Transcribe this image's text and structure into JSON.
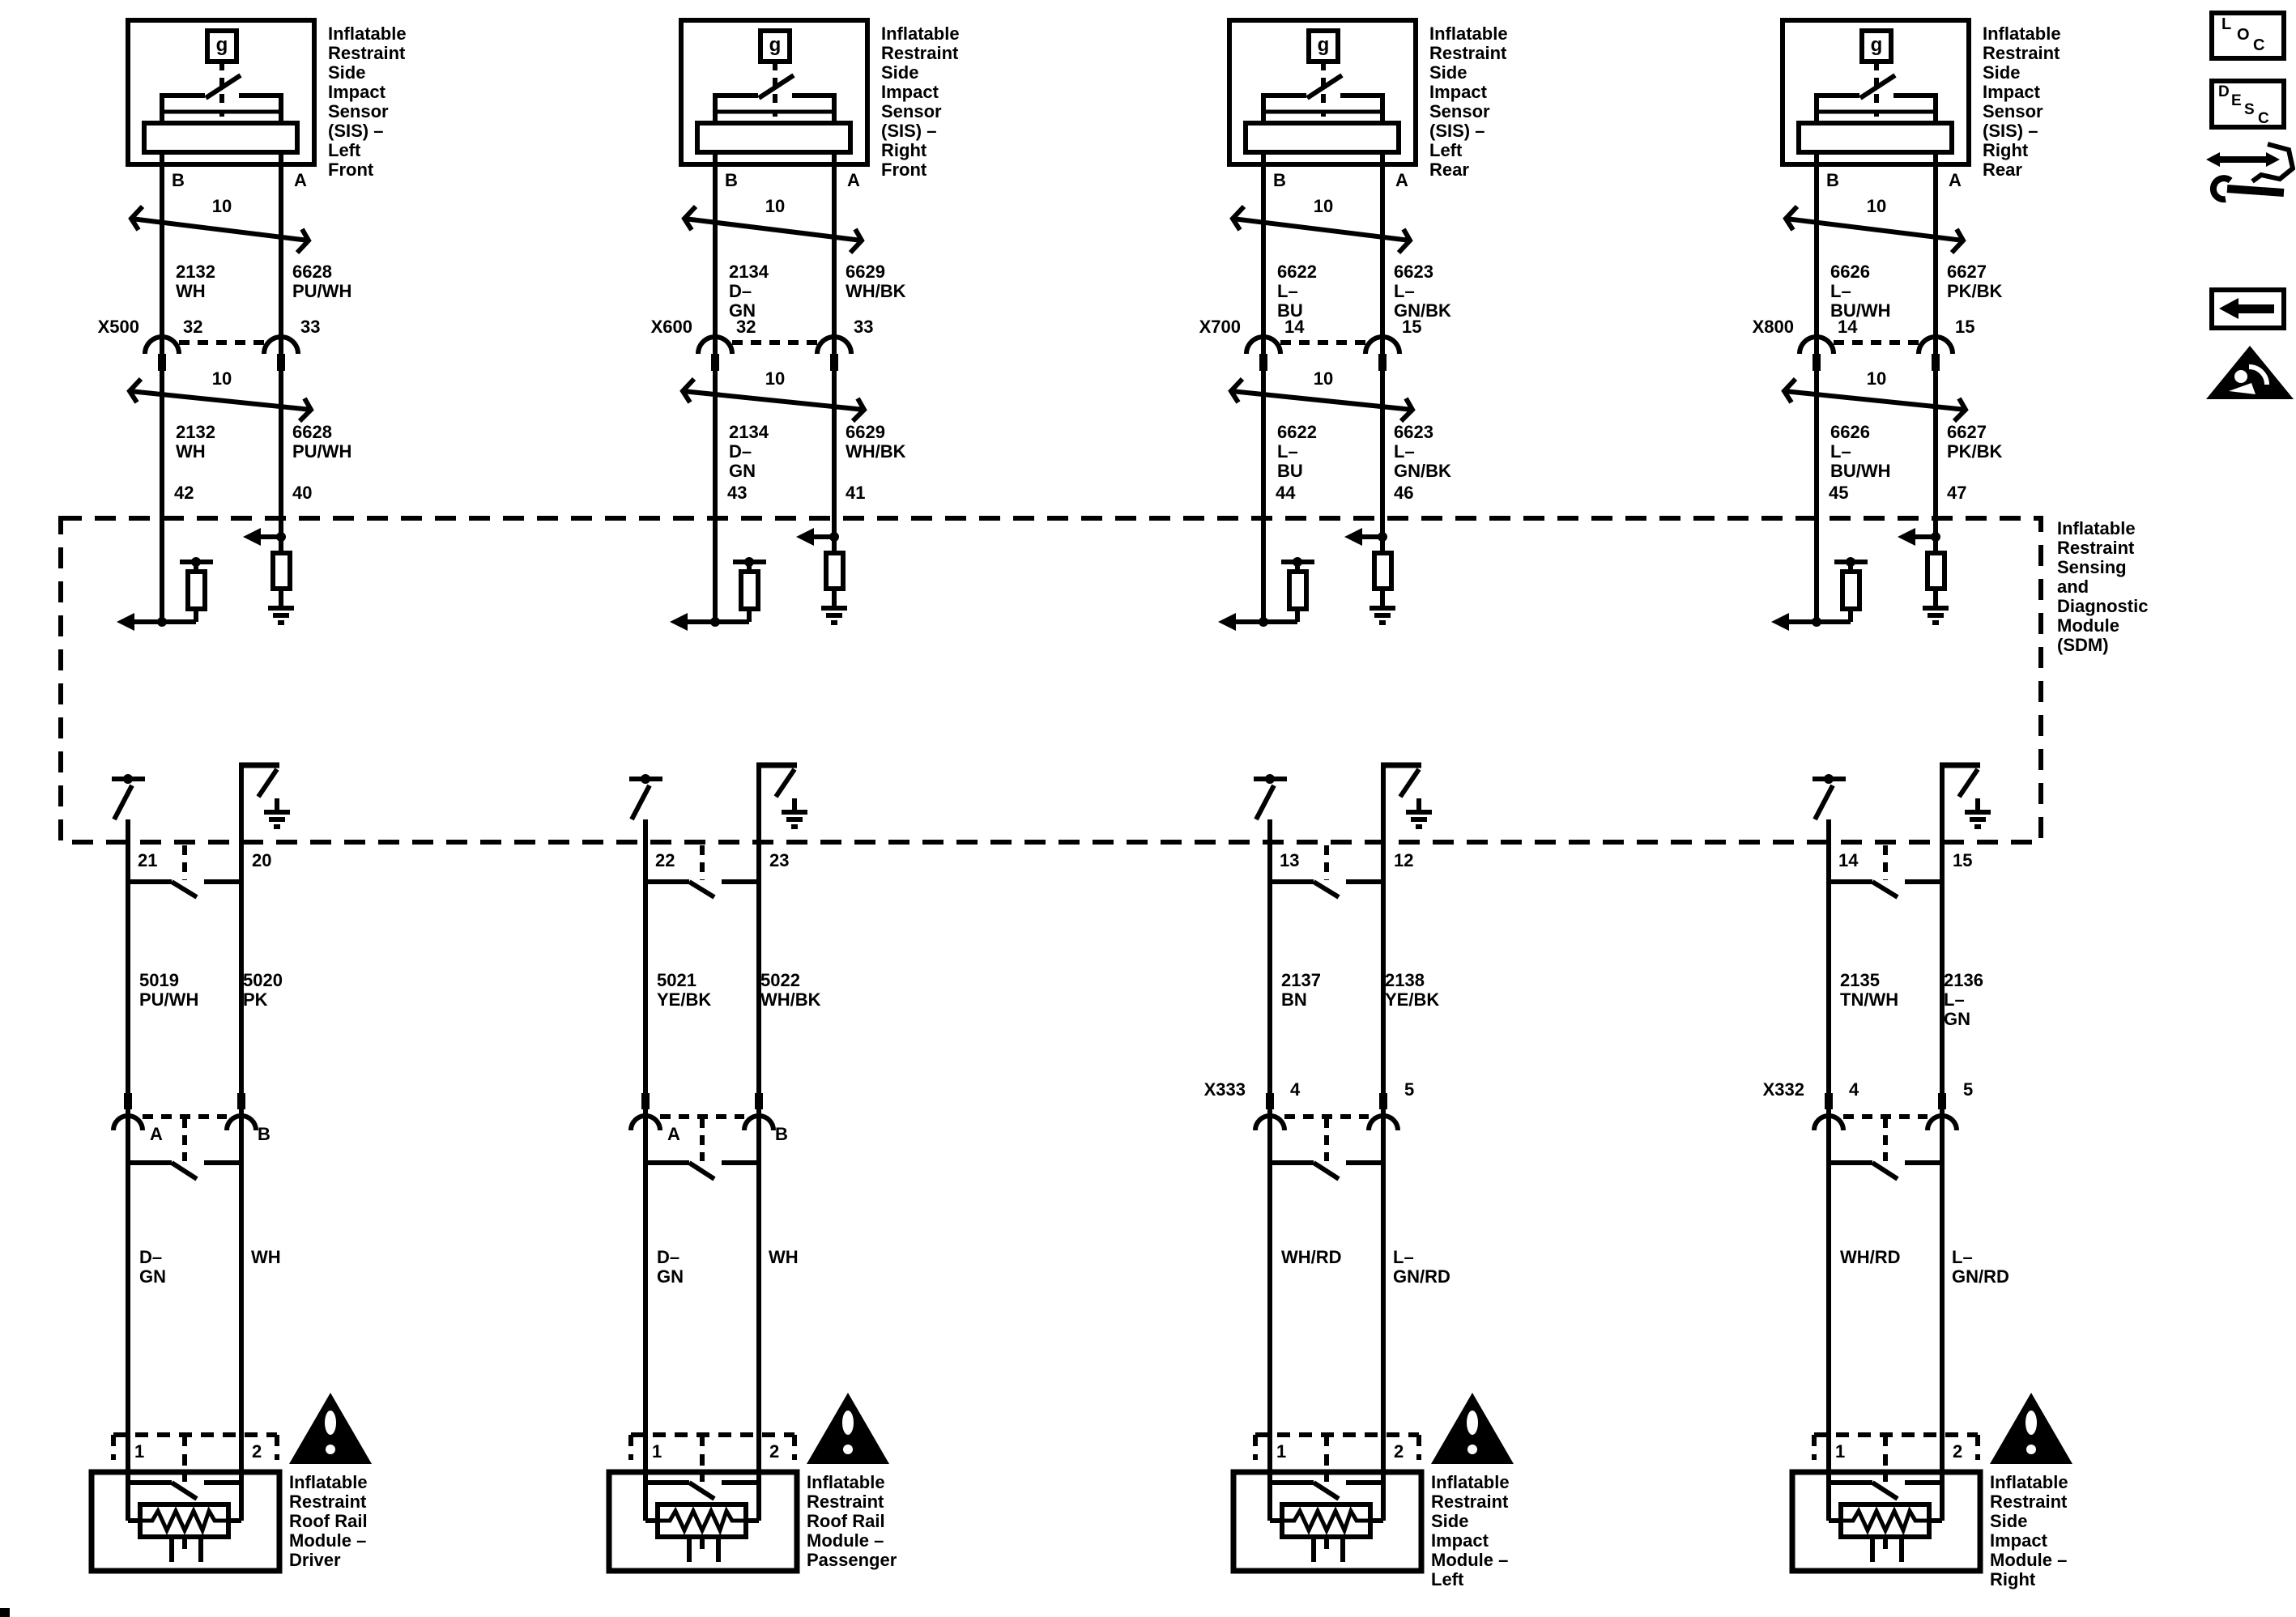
{
  "sdm": {
    "label": "Inflatable\nRestraint\nSensing\nand\nDiagnostic\nModule\n(SDM)"
  },
  "toolbar": {
    "loc_letters": [
      "L",
      "O",
      "C"
    ],
    "desc_letters": [
      "D",
      "E",
      "S",
      "C"
    ]
  },
  "columns": [
    {
      "sensor_label": "Inflatable\nRestraint\nSide\nImpact\nSensor\n(SIS) –\nLeft\nFront",
      "sensor_icon": "g",
      "pin_top_left": "B",
      "pin_top_right": "A",
      "twist_upper": "10",
      "twist_lower": "10",
      "harness_connector": "X500",
      "harness_pin_left": "32",
      "harness_pin_right": "33",
      "wire_upper_left": "2132\nWH",
      "wire_upper_right": "6628\nPU/WH",
      "wire_mid_left": "2132\nWH",
      "wire_mid_right": "6628\nPU/WH",
      "sdm_pin_left": "42",
      "sdm_pin_right": "40",
      "sdm_out_pin_left": "21",
      "sdm_out_pin_right": "20",
      "wire_lower_left": "5019\nPU/WH",
      "wire_lower_right": "5020\nPK",
      "lower_pin_left": "A",
      "lower_pin_right": "B",
      "color_left": "D–GN",
      "color_right": "WH",
      "module_pin_left": "1",
      "module_pin_right": "2",
      "module_label": "Inflatable\nRestraint\nRoof Rail\nModule –\nDriver"
    },
    {
      "sensor_label": "Inflatable\nRestraint\nSide\nImpact\nSensor\n(SIS) –\nRight\nFront",
      "sensor_icon": "g",
      "pin_top_left": "B",
      "pin_top_right": "A",
      "twist_upper": "10",
      "twist_lower": "10",
      "harness_connector": "X600",
      "harness_pin_left": "32",
      "harness_pin_right": "33",
      "wire_upper_left": "2134\nD–GN",
      "wire_upper_right": "6629\nWH/BK",
      "wire_mid_left": "2134\nD–GN",
      "wire_mid_right": "6629\nWH/BK",
      "sdm_pin_left": "43",
      "sdm_pin_right": "41",
      "sdm_out_pin_left": "22",
      "sdm_out_pin_right": "23",
      "wire_lower_left": "5021\nYE/BK",
      "wire_lower_right": "5022\nWH/BK",
      "lower_pin_left": "A",
      "lower_pin_right": "B",
      "color_left": "D–GN",
      "color_right": "WH",
      "module_pin_left": "1",
      "module_pin_right": "2",
      "module_label": "Inflatable\nRestraint\nRoof Rail\nModule –\nPassenger"
    },
    {
      "sensor_label": "Inflatable\nRestraint\nSide\nImpact\nSensor\n(SIS) –\nLeft\nRear",
      "sensor_icon": "g",
      "pin_top_left": "B",
      "pin_top_right": "A",
      "twist_upper": "10",
      "twist_lower": "10",
      "harness_connector": "X700",
      "harness_pin_left": "14",
      "harness_pin_right": "15",
      "wire_upper_left": "6622\nL–BU",
      "wire_upper_right": "6623\nL–GN/BK",
      "wire_mid_left": "6622\nL–BU",
      "wire_mid_right": "6623\nL–GN/BK",
      "sdm_pin_left": "44",
      "sdm_pin_right": "46",
      "sdm_out_pin_left": "13",
      "sdm_out_pin_right": "12",
      "wire_lower_left": "2137\nBN",
      "wire_lower_right": "2138\nYE/BK",
      "lower_connector": "X333",
      "lower_pin_left": "4",
      "lower_pin_right": "5",
      "color_left": "WH/RD",
      "color_right": "L–GN/RD",
      "module_pin_left": "1",
      "module_pin_right": "2",
      "module_label": "Inflatable\nRestraint\nSide\nImpact\nModule –\nLeft"
    },
    {
      "sensor_label": "Inflatable\nRestraint\nSide\nImpact\nSensor\n(SIS) –\nRight\nRear",
      "sensor_icon": "g",
      "pin_top_left": "B",
      "pin_top_right": "A",
      "twist_upper": "10",
      "twist_lower": "10",
      "harness_connector": "X800",
      "harness_pin_left": "14",
      "harness_pin_right": "15",
      "wire_upper_left": "6626\nL–BU/WH",
      "wire_upper_right": "6627\nPK/BK",
      "wire_mid_left": "6626\nL–BU/WH",
      "wire_mid_right": "6627\nPK/BK",
      "sdm_pin_left": "45",
      "sdm_pin_right": "47",
      "sdm_out_pin_left": "14",
      "sdm_out_pin_right": "15",
      "wire_lower_left": "2135\nTN/WH",
      "wire_lower_right": "2136\nL–GN",
      "lower_connector": "X332",
      "lower_pin_left": "4",
      "lower_pin_right": "5",
      "color_left": "WH/RD",
      "color_right": "L–GN/RD",
      "module_pin_left": "1",
      "module_pin_right": "2",
      "module_label": "Inflatable\nRestraint\nSide\nImpact\nModule –\nRight"
    }
  ]
}
